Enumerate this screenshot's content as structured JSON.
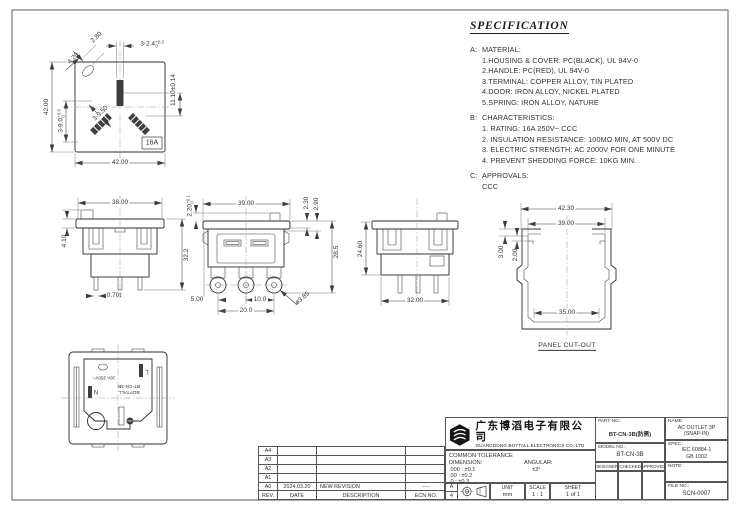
{
  "spec": {
    "title": "SPECIFICATION",
    "sections": [
      {
        "label": "A:",
        "heading": "MATERIAL:",
        "items": [
          "1.HOUSING & COVER: PC(BLACK), UL 94V-0",
          "2.HANDLE: PC(RED), UL 94V-0",
          "3.TERMINAL: COPPER ALLOY, TIN PLATED",
          "4.DOOR: IRON ALLOY, NICKEL PLATED",
          "5.SPRING: IRON ALLOY, NATURE"
        ]
      },
      {
        "label": "B:",
        "heading": "CHARACTERISTICS:",
        "items": [
          "1. RATING: 16A 250V~ CCC",
          "2. INSULATION RESISTANCE: 100MΩ MIN, AT 500V DC",
          "3. ELECTRIC STRENGTH: AC 2000V FOR ONE MINUTE",
          "4. PREVENT SHEDDING FORCE: 10KG MIN."
        ]
      },
      {
        "label": "C:",
        "heading": "APPROVALS:",
        "items": [
          "CCC"
        ]
      }
    ]
  },
  "views": {
    "face": {
      "size_left": "42.00",
      "size_bottom": "42.00",
      "slot_len": {
        "v": "3-9.0",
        "tp": "+0.5",
        "tm": "0"
      },
      "slot_width": {
        "v": "3-2.4",
        "tp": "+0.3",
        "tm": "0"
      },
      "pin_offset": "11.10±0.14",
      "hole_minor_axis": "2.80",
      "hole_major_axis": "4.20",
      "slot_pitch": "3-9.50",
      "rating_label": "16A"
    },
    "side_a": {
      "width_top": "38.00",
      "flange_h": "4.10",
      "total_h": "32.2",
      "pin_thickness": "0.70t"
    },
    "front": {
      "width_top": "39.00",
      "tab_height": {
        "v": "2.20",
        "tp": "+0.1",
        "tm": "0"
      },
      "step_a": "2.30",
      "step_b": "2.90",
      "height": "28.5",
      "pin_edge_offset": "5.00",
      "pin_pitch": "10.0",
      "pin_span": "20.0",
      "pin_dia": "ø3.85"
    },
    "side_b": {
      "height": "24.60",
      "width": "32.00"
    },
    "cutout": {
      "w_outer": "42.30",
      "w_inner": "39.00",
      "hook_depth": "3.00",
      "hook_step": "2.00",
      "w_bottom": "35.00",
      "caption": "PANEL CUT-OUT"
    },
    "rear": {
      "rating": "16A 250V~",
      "live": "L",
      "neutral": "N",
      "brand": "BOYTALL",
      "model": "BT-CN-3B"
    }
  },
  "revision": {
    "headers": [
      "REV.",
      "DATE",
      "DESCRIPTION",
      "ECN NO."
    ],
    "rows": [
      {
        "rev": "A4",
        "date": "",
        "desc": "",
        "ecn": ""
      },
      {
        "rev": "A3",
        "date": "",
        "desc": "",
        "ecn": ""
      },
      {
        "rev": "A2",
        "date": "",
        "desc": "",
        "ecn": ""
      },
      {
        "rev": "A1",
        "date": "",
        "desc": "",
        "ecn": ""
      },
      {
        "rev": "A0",
        "date": "2024.03.20",
        "desc": "NEW REVISION",
        "ecn": "----"
      }
    ]
  },
  "title_block": {
    "company_cn": "广东博滔电子有限公司",
    "company_en": "GUANGDONG BOYTALL ELECTRONICS CO.,LTD",
    "part_no_label": "PART NO.:",
    "part_no": "BT-CN-3B(防黑)",
    "name_label": "NAME:",
    "name_line1": "AC OUTLET 3P",
    "name_line2": "(SNAP-IN)",
    "model_no_label": "MODEL NO.:",
    "model_no": "BT-CN-3B",
    "spec_label": "SPEC.:",
    "spec_line1": "IEC 60884-1",
    "spec_line2": "GB 1002",
    "tolerance": {
      "title": "COMMON TOLERANCE",
      "dimension_label": "DIMENSION:",
      "angular_label": "ANGULAR:",
      "row1": ".000 : ±0.1",
      "row2": ".00  : ±0.2",
      "row3": ".0   : ±0.3",
      "angular_value": "±3°"
    },
    "paper_a": "A",
    "paper_4": "4",
    "unit_label": "UNIT",
    "unit_value": "mm",
    "scale_label": "SCALE",
    "scale_value": "1 : 1",
    "sheet_label": "SHEET",
    "sheet_value": "1 of 1",
    "designer_label": "DESIGNER",
    "checked_label": "CHECKED",
    "approved_label": "APPROVED",
    "note_label": "NOTE:",
    "file_no_label": "FILE NO.:",
    "file_no": "SCN-0007"
  }
}
